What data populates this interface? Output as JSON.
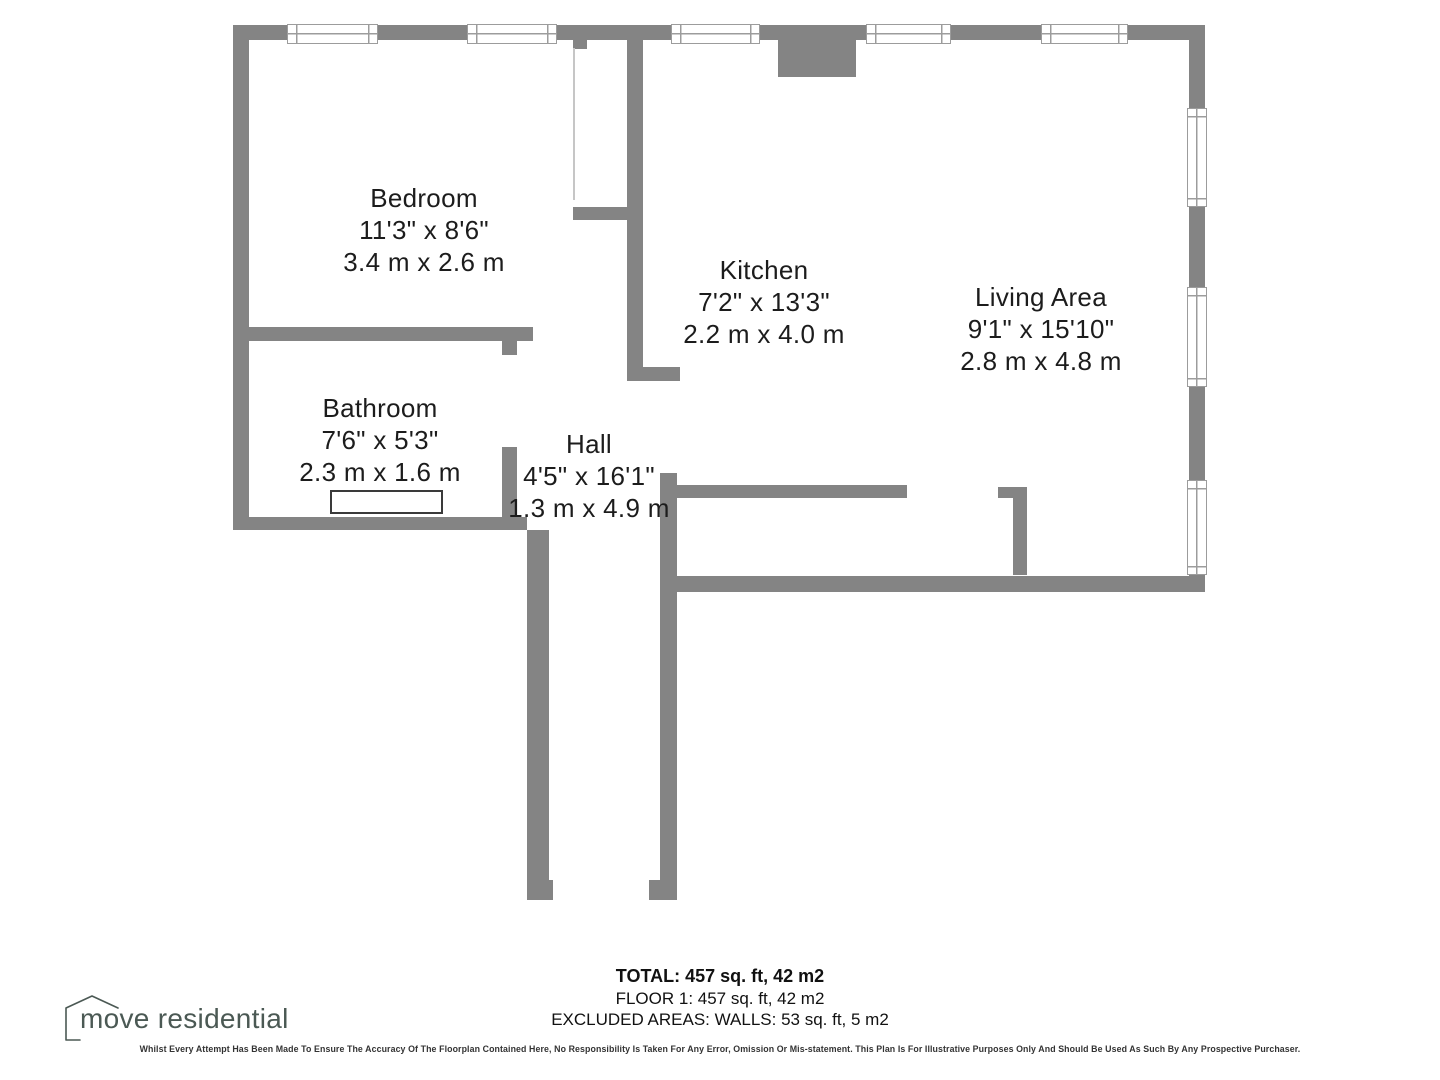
{
  "colors": {
    "wall": "#848484",
    "winb": "#9c9c9c",
    "partition": "#c6c6c6",
    "label": "#1c1c1c",
    "footer": "#111111",
    "logo": "#4b5954",
    "tub": "#3a3a3a"
  },
  "rooms": {
    "bedroom": {
      "name": "Bedroom",
      "imperial": "11'3\" x 8'6\"",
      "metric": "3.4 m x 2.6 m"
    },
    "kitchen": {
      "name": "Kitchen",
      "imperial": "7'2\" x 13'3\"",
      "metric": "2.2 m x 4.0 m"
    },
    "living": {
      "name": "Living Area",
      "imperial": "9'1\" x 15'10\"",
      "metric": "2.8 m x 4.8 m"
    },
    "bathroom": {
      "name": "Bathroom",
      "imperial": "7'6\" x 5'3\"",
      "metric": "2.3 m x 1.6 m"
    },
    "hall": {
      "name": "Hall",
      "imperial": "4'5\" x 16'1\"",
      "metric": "1.3 m x 4.9 m"
    }
  },
  "footer": {
    "total": "TOTAL: 457 sq. ft, 42 m2",
    "floor": "FLOOR 1: 457 sq. ft, 42 m2",
    "excluded": "EXCLUDED AREAS: WALLS: 53 sq. ft, 5 m2"
  },
  "disclaimer": "Whilst Every Attempt Has Been Made To Ensure The Accuracy Of The Floorplan Contained Here, No Responsibility Is Taken For Any Error, Omission Or Mis-statement. This Plan Is For Illustrative Purposes Only And Should Be Used As Such By Any Prospective Purchaser.",
  "logo": {
    "text": "move residential"
  }
}
